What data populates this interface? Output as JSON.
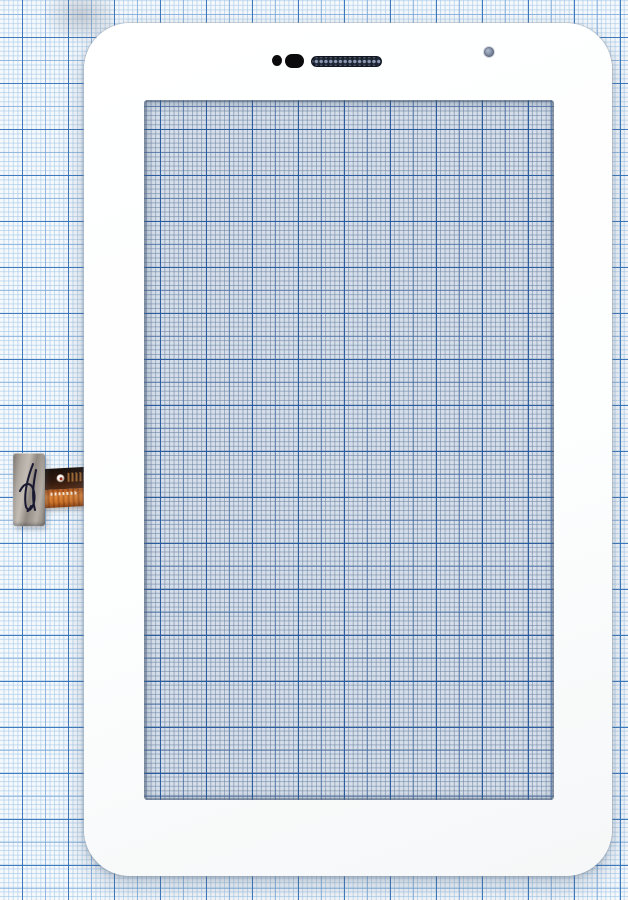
{
  "image": {
    "kind": "product-photo",
    "subject": "White touchscreen digitizer front glass for a 7-inch tablet lying on blue millimeter graph paper",
    "visible_text": "none (only tiny illegible markings printed on the flex ribbon cable)"
  },
  "colors": {
    "paper_base": "#f6f9fc",
    "grid_fine": "#a8cbe9",
    "grid_medium": "#78a5d7",
    "grid_bold": "#2f6fb7",
    "frame_white": "#ffffff",
    "glass_tint": "#d6dfe9",
    "glass_grid_bold": "#24589e",
    "speaker_dark": "#1b2230",
    "speaker_mesh_dot": "#8a97b2",
    "sensor_black": "#0b0b0e",
    "camera_hole": "#8591a8",
    "connector_silver": "#aaa49d",
    "ribbon_orange": "#d0752a",
    "ribbon_dark_band": "#31190e",
    "qc_ink": "#181830"
  },
  "parts": {
    "paper": {
      "label": "Blue millimeter graph paper background"
    },
    "smudge": {
      "label": "Faint gray smudge on the paper near top-left"
    },
    "frame": {
      "label": "White digitizer frame (front glass panel, rounded corners)"
    },
    "window": {
      "label": "Transparent glass window showing tinted graph paper through it"
    },
    "proximity_dot": {
      "label": "Round black sensor hole"
    },
    "sensor_pill": {
      "label": "Black rounded sensor slot"
    },
    "speaker": {
      "label": "Earpiece speaker grille with mesh dots"
    },
    "camera": {
      "label": "Front camera hole"
    },
    "flex": {
      "label": "Touchscreen flex cable assembly at left edge"
    },
    "connector": {
      "label": "Silver flex connector end"
    },
    "qc_mark": {
      "label": "Handwritten dark ink QC mark on connector"
    },
    "ribbon": {
      "label": "Orange flex ribbon cable"
    },
    "ribbon_logo": {
      "label": "Small white circular logo on ribbon"
    },
    "ribbon_marking": {
      "label": "Illegible tiny printed marking on ribbon"
    }
  }
}
